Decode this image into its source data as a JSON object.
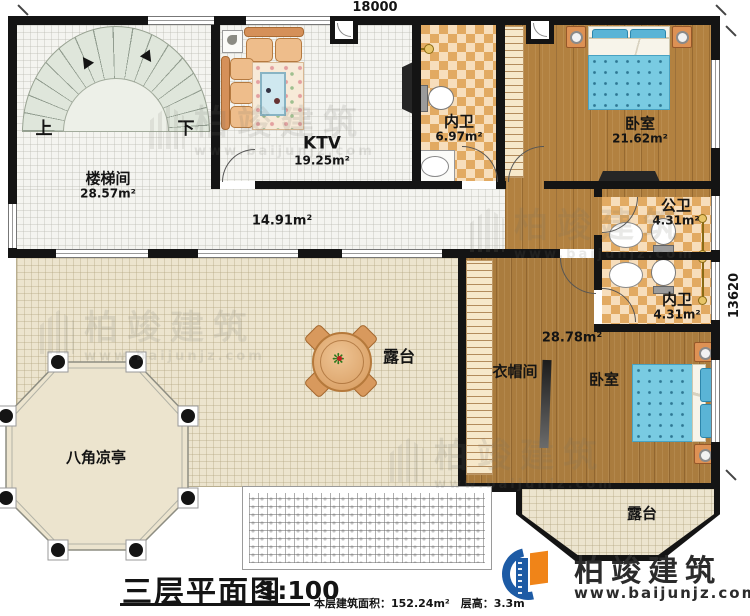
{
  "dimensions": {
    "top": "18000",
    "right": "13620"
  },
  "rooms": {
    "stair_hall": {
      "label": "楼梯间",
      "area": "28.57m²",
      "up": "上",
      "down": "下"
    },
    "ktv": {
      "label": "KTV",
      "area": "19.25m²"
    },
    "bath_top": {
      "label": "内卫",
      "area": "6.97m²"
    },
    "bedroom_top": {
      "label": "卧室",
      "area": "21.62m²"
    },
    "hallway": {
      "area": "14.91m²"
    },
    "public_bath": {
      "label": "公卫",
      "area": "4.31m²"
    },
    "bath_right": {
      "label": "内卫",
      "area": "4.31m²"
    },
    "cloakroom": {
      "label": "衣帽间"
    },
    "bedroom_bottom": {
      "label": "卧室",
      "area": "28.78m²"
    },
    "terrace": {
      "label": "露台"
    },
    "terrace_bay": {
      "label": "露台"
    },
    "pavilion": {
      "label": "八角凉亭"
    }
  },
  "title_block": {
    "title": "三层平面图",
    "scale": "1:100",
    "info": "本层建筑面积：152.24m²　层高：3.3m"
  },
  "logo": {
    "name": "柏竣建筑",
    "url": "www.baijunjz.com"
  },
  "watermark": {
    "name": "柏竣建筑",
    "url": "www.baijunjz.com"
  },
  "colors": {
    "wall": "#141414",
    "wood": "#b28140",
    "tile_light": "#f7debc",
    "tile_dark": "#e2aa62",
    "terrace": "#ece4ce",
    "bed_blue": "#79cbe2",
    "logo_blue": "#1d5ba5",
    "logo_orange": "#f08418"
  }
}
